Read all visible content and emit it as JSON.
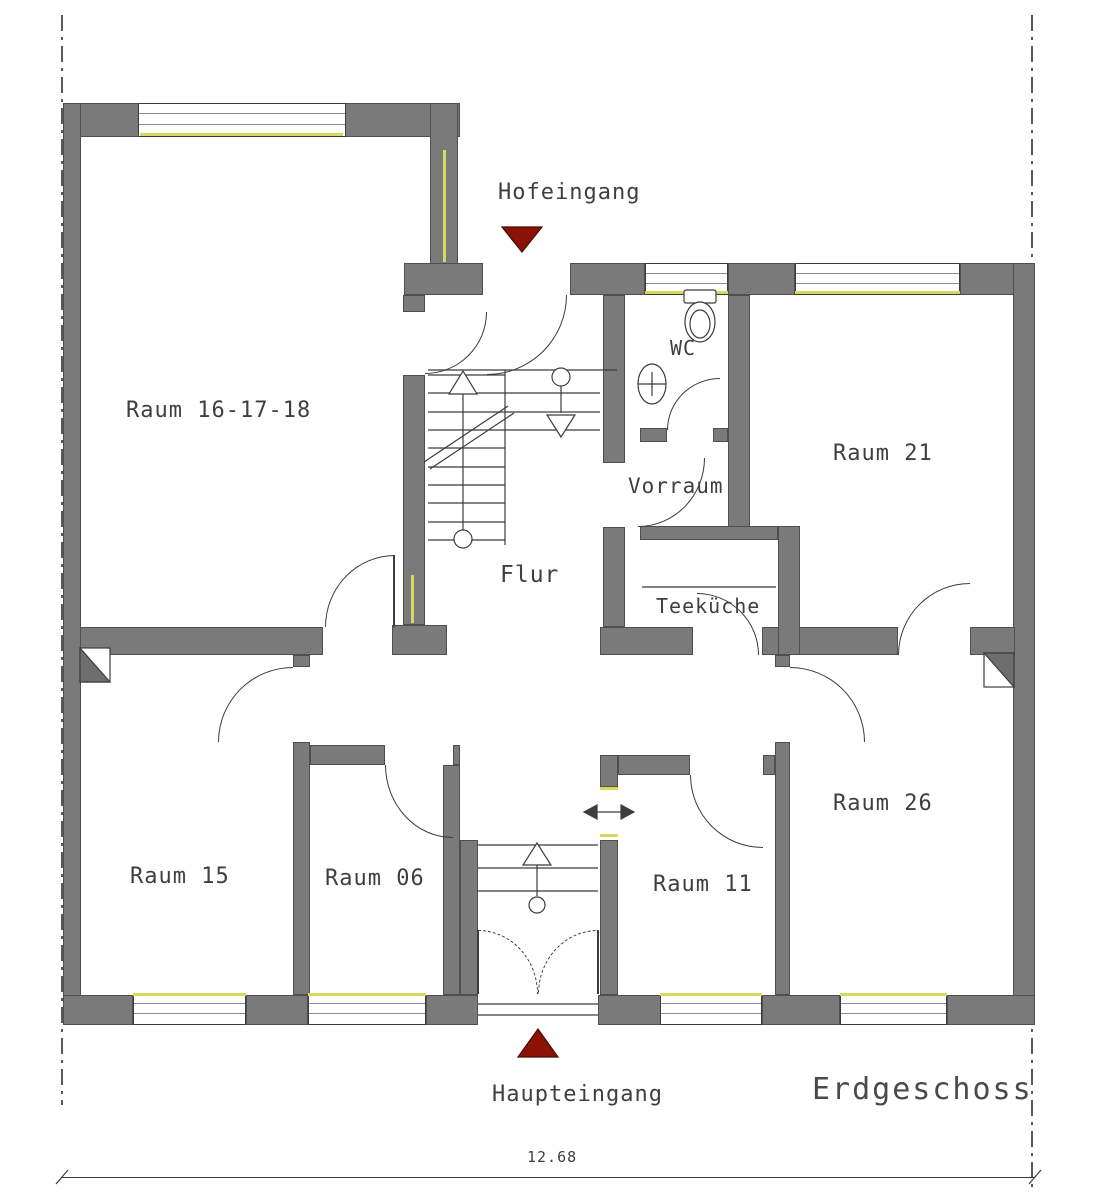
{
  "plan": {
    "floor_label": "Erdgeschoss",
    "top_entrance_label": "Hofeingang",
    "bottom_entrance_label": "Haupteingang",
    "dimension_label": "12.68",
    "rooms": [
      {
        "id": "raum-16-17-18",
        "label": "Raum 16-17-18"
      },
      {
        "id": "raum-21",
        "label": "Raum 21"
      },
      {
        "id": "raum-15",
        "label": "Raum 15"
      },
      {
        "id": "raum-06",
        "label": "Raum 06"
      },
      {
        "id": "raum-11",
        "label": "Raum 11"
      },
      {
        "id": "raum-26",
        "label": "Raum 26"
      },
      {
        "id": "flur",
        "label": "Flur"
      },
      {
        "id": "wc",
        "label": "WC"
      },
      {
        "id": "vorraum",
        "label": "Vorraum"
      },
      {
        "id": "teekueche",
        "label": "Teeküche"
      }
    ]
  },
  "colors": {
    "wall": "#7a7a7a",
    "wall_outline": "#4f4f4f",
    "linework": "#3c3c3c",
    "window_sill_yellow": "#d8d75f",
    "entrance_marker_red": "#8a1206",
    "text": "#3f3f3f"
  }
}
